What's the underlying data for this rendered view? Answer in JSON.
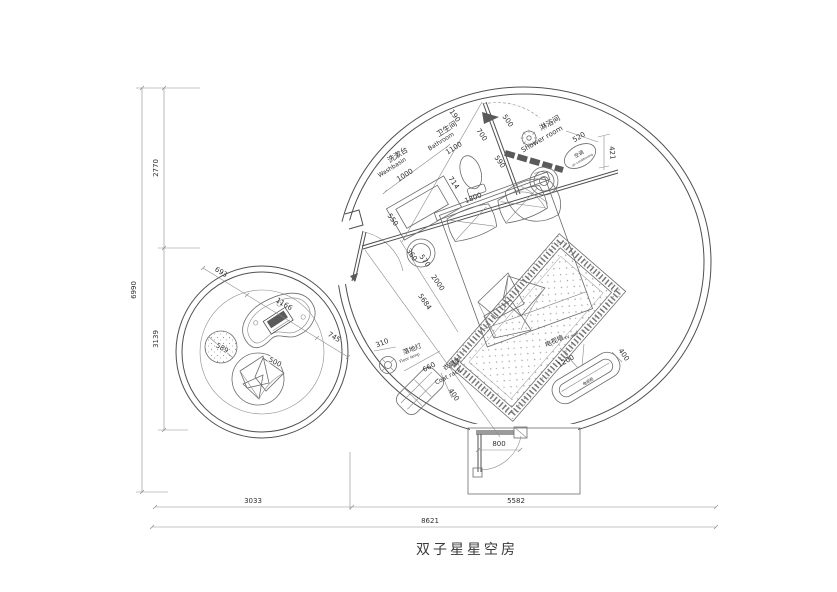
{
  "title": "双子星星空房",
  "rooms": {
    "washbasin": {
      "cn": "洗漱台",
      "en": "Washbasin"
    },
    "bathroom": {
      "cn": "卫生间",
      "en": "Bathroom"
    },
    "shower": {
      "cn": "淋浴间",
      "en": "Shower room"
    },
    "ac": {
      "cn": "空调",
      "en": "air conditioning"
    },
    "floor_lamp": {
      "cn": "落地灯",
      "en": "Floor lamp"
    },
    "coat_rack": {
      "cn": "衣帽架",
      "en": "Coat rack"
    },
    "tv_wall": {
      "cn": "电视墙",
      "en": "TV wall"
    },
    "tv_cabinet": {
      "cn": "电视柜"
    }
  },
  "dims": {
    "overall_height": "6990",
    "height_top": "2770",
    "height_bottom": "3139",
    "width_left": "3033",
    "width_right": "5582",
    "overall_width": "8621",
    "door": "800",
    "bath_190": "190",
    "bath_700": "700",
    "bath_500": "500",
    "bath_590": "590",
    "bath_1100": "1100",
    "wash_1000": "1000",
    "wash_550": "550",
    "toilet_714": "714",
    "bed_1800": "1800",
    "bed_2000": "2000",
    "stool_360": "360",
    "stool_570": "570",
    "diag_5684": "5684",
    "shower_520": "520",
    "ac_421": "421",
    "lamp_310": "310",
    "coat_660": "660",
    "coat_400": "400",
    "tv_1200": "1200",
    "tv_400": "400",
    "lounge_693": "693",
    "desk_1166": "1166",
    "lounge_745": "745",
    "pouf_589": "589",
    "beanbag_500": "500"
  },
  "colors": {
    "line": "#6b6b6b",
    "wall": "#4f4f4f",
    "dark_fill": "#5a5a5a"
  }
}
